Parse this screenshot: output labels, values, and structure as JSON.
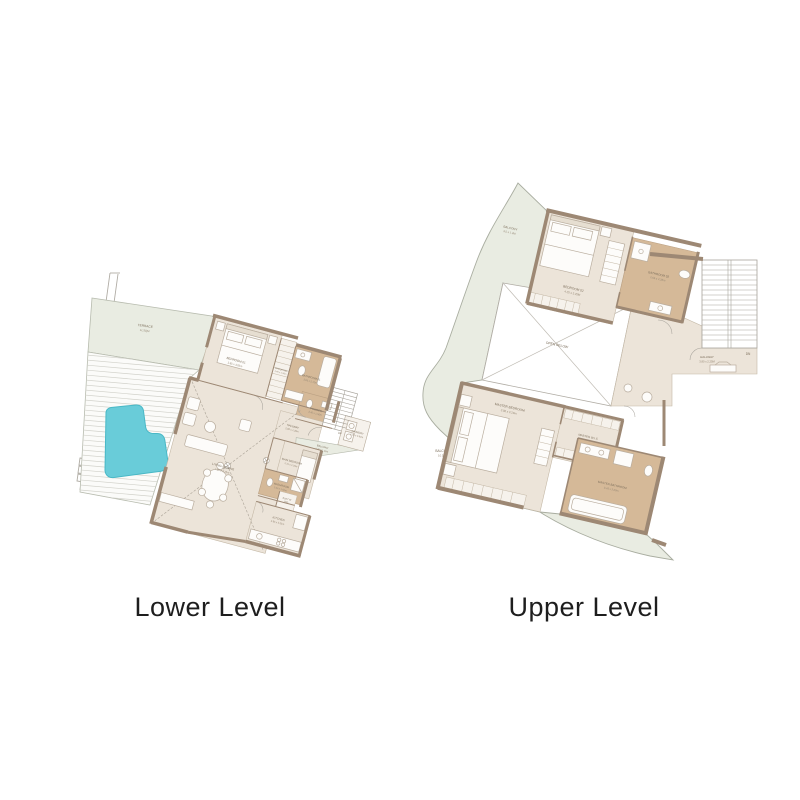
{
  "colors": {
    "background": "#ffffff",
    "terrace_sage": "#e9ece2",
    "floor_cream": "#ece4d9",
    "wetroom_tan": "#d5b998",
    "wall_brown": "#9d8874",
    "pool_teal": "#69ccd9",
    "line_gray": "#a8a49c",
    "title_text": "#1e1e1e",
    "label_text": "#7d6f5c"
  },
  "lower": {
    "title": "Lower Level",
    "rooms": {
      "terrace": {
        "name": "TERRACE",
        "dims": "11.5QM"
      },
      "bedroom1": {
        "name": "BEDROOM 01",
        "dims": "3.85 x 3.05m"
      },
      "wardrobe": {
        "name": "WARDROBE",
        "dims": "2.40 x 1.00m"
      },
      "bathroom1": {
        "name": "BATHROOM 01",
        "dims": "2.65 x 2.70m"
      },
      "powder": {
        "name": "POWDER",
        "dims": "2.40 x 1.50m"
      },
      "hallway": {
        "name": "HALLWAY",
        "dims": "2.00 x 1.20m"
      },
      "stairs": {
        "label": "UP"
      },
      "laundry": {
        "name": "LAUNDRY",
        "dims": "2.00 x 0.80m"
      },
      "balcony": {
        "name": "BALCONY",
        "dims": "3.45 x 1.00m"
      },
      "living": {
        "name": "LIVING / DINING",
        "dims": "7.00 x 3.70m"
      },
      "maid": {
        "name": "MAIN BEDROOM",
        "dims": "2.70 x 2.20m"
      },
      "washroom": {
        "name": "WASHROOM",
        "dims": "2.00 x 1.60m"
      },
      "builtin": {
        "name": "BUILT IN",
        "dims": "W/D"
      },
      "kitchen": {
        "name": "KITCHEN",
        "dims": "2.95 x 2.35m"
      }
    }
  },
  "upper": {
    "title": "Upper Level",
    "rooms": {
      "balcony_top": {
        "name": "BALCONY",
        "dims": "3.5 x 1.3M"
      },
      "bedroom2": {
        "name": "BEDROOM 02",
        "dims": "4.25 x 3.25M"
      },
      "bathroom2": {
        "name": "BATHROOM 02",
        "dims": "2.65 x 2.35m"
      },
      "open_below": {
        "name": "OPEN BELOW"
      },
      "hallway": {
        "name": "HALLWAY",
        "dims": "3.80 x 2.25M"
      },
      "stairs": {
        "label": "DN"
      },
      "master_bedroom": {
        "name": "MASTER BEDROOM",
        "dims": "3.80 x 3.20m"
      },
      "master_wic": {
        "name": "MASTER W.I.C",
        "dims": "2.05 x 1.60m"
      },
      "master_bath": {
        "name": "MASTER BATHROOM",
        "dims": "3.45 x 2.00m"
      },
      "balcony_left": {
        "name": "BALCONY",
        "dims": "10.5QM"
      }
    }
  }
}
